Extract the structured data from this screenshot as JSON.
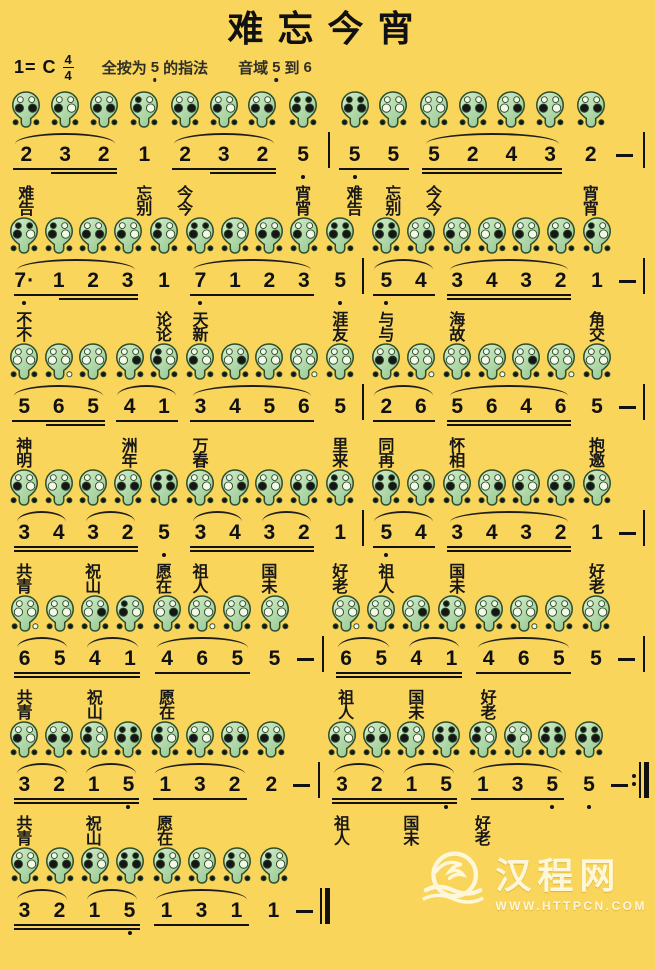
{
  "colors": {
    "bg": "#f9d55c",
    "ink": "#111111",
    "ocarina_light": "#d8efcd",
    "ocarina_dark": "#8fc48b",
    "ocarina_outline": "#2e4d2c",
    "hole_closed": "#161616",
    "hole_open": "#f4f8e6",
    "watermark": "#fffdf0"
  },
  "title": "难忘今宵",
  "header": {
    "key": "1= C",
    "beat_top": "4",
    "beat_bottom": "4",
    "fingering_pre": "全按为",
    "fingering_note": "5",
    "fingering_post": "的指法",
    "range_pre": "音域",
    "range_low": "5",
    "range_mid": "到",
    "range_high": "6"
  },
  "fingering_map": {
    "5.": [
      1,
      1,
      1,
      1,
      1,
      1
    ],
    "7.": [
      1,
      1,
      1,
      0,
      1,
      1
    ],
    "1": [
      1,
      0,
      1,
      0,
      1,
      1
    ],
    "2": [
      0,
      0,
      1,
      1,
      1,
      1
    ],
    "3": [
      0,
      0,
      1,
      0,
      1,
      1
    ],
    "4": [
      0,
      0,
      0,
      1,
      1,
      1
    ],
    "5": [
      0,
      0,
      0,
      0,
      1,
      1
    ],
    "6": [
      0,
      0,
      0,
      0,
      1,
      0
    ]
  },
  "score": {
    "lines": [
      {
        "groups": [
          {
            "u": 1,
            "u2p": true,
            "slurs": [
              [
                0,
                2
              ]
            ],
            "notes": [
              {
                "p": "2",
                "l1": "难",
                "l2": "告"
              },
              {
                "p": "3"
              },
              {
                "p": "2"
              }
            ]
          },
          {
            "notes": [
              {
                "p": "1",
                "l1": "忘",
                "l2": "别"
              }
            ]
          },
          {
            "u": 1,
            "u2p": true,
            "slurs": [
              [
                0,
                2
              ]
            ],
            "notes": [
              {
                "p": "2",
                "l1": "今",
                "l2": "今"
              },
              {
                "p": "3"
              },
              {
                "p": "2"
              }
            ]
          },
          {
            "notes": [
              {
                "p": "5.",
                "l1": "宵",
                "l2": "宵"
              }
            ]
          },
          {
            "type": "bar"
          },
          {
            "u": 1,
            "notes": [
              {
                "p": "5.",
                "l1": "难",
                "l2": "告"
              },
              {
                "p": "5",
                "l1": "忘",
                "l2": "别"
              }
            ]
          },
          {
            "u": 2,
            "slurs": [
              [
                0,
                3
              ]
            ],
            "notes": [
              {
                "p": "5",
                "l1": "今",
                "l2": "今"
              },
              {
                "p": "2"
              },
              {
                "p": "4"
              },
              {
                "p": "3"
              }
            ]
          },
          {
            "notes": [
              {
                "p": "2",
                "l1": "宵",
                "l2": "宵"
              }
            ]
          },
          {
            "type": "dash"
          },
          {
            "type": "bar"
          }
        ]
      },
      {
        "groups": [
          {
            "u": 1,
            "u2p": true,
            "slurs": [
              [
                0,
                3
              ]
            ],
            "notes": [
              {
                "p": "7.",
                "da": true,
                "l1": "不",
                "l2": "不"
              },
              {
                "p": "1"
              },
              {
                "p": "2"
              },
              {
                "p": "3"
              }
            ]
          },
          {
            "notes": [
              {
                "p": "1",
                "l1": "论",
                "l2": "论"
              }
            ]
          },
          {
            "u": 1,
            "slurs": [
              [
                0,
                3
              ]
            ],
            "notes": [
              {
                "p": "7.",
                "l1": "天",
                "l2": "新"
              },
              {
                "p": "1"
              },
              {
                "p": "2"
              },
              {
                "p": "3"
              }
            ]
          },
          {
            "notes": [
              {
                "p": "5.",
                "l1": "涯",
                "l2": "友"
              }
            ]
          },
          {
            "type": "bar"
          },
          {
            "u": 1,
            "slurs": [
              [
                0,
                1
              ]
            ],
            "notes": [
              {
                "p": "5.",
                "l1": "与",
                "l2": "与"
              },
              {
                "p": "4"
              }
            ]
          },
          {
            "u": 2,
            "slurs": [
              [
                0,
                3
              ]
            ],
            "notes": [
              {
                "p": "3",
                "l1": "海",
                "l2": "故"
              },
              {
                "p": "4"
              },
              {
                "p": "3"
              },
              {
                "p": "2"
              }
            ]
          },
          {
            "notes": [
              {
                "p": "1",
                "l1": "角",
                "l2": "交"
              }
            ]
          },
          {
            "type": "dash"
          },
          {
            "type": "bar"
          }
        ]
      },
      {
        "groups": [
          {
            "u": 1,
            "u2p": true,
            "slurs": [
              [
                0,
                2
              ]
            ],
            "notes": [
              {
                "p": "5",
                "l1": "神",
                "l2": "明"
              },
              {
                "p": "6"
              },
              {
                "p": "5"
              }
            ]
          },
          {
            "u": 1,
            "slurs": [
              [
                0,
                1
              ]
            ],
            "notes": [
              {
                "p": "4",
                "l1": "洲",
                "l2": "年"
              },
              {
                "p": "1"
              }
            ]
          },
          {
            "u": 1,
            "slurs": [
              [
                0,
                3
              ]
            ],
            "notes": [
              {
                "p": "3",
                "l1": "万",
                "l2": "春"
              },
              {
                "p": "4"
              },
              {
                "p": "5"
              },
              {
                "p": "6"
              }
            ]
          },
          {
            "notes": [
              {
                "p": "5",
                "l1": "里",
                "l2": "来"
              }
            ]
          },
          {
            "type": "bar"
          },
          {
            "u": 1,
            "slurs": [
              [
                0,
                1
              ]
            ],
            "notes": [
              {
                "p": "2",
                "l1": "同",
                "l2": "再"
              },
              {
                "p": "6"
              }
            ]
          },
          {
            "u": 2,
            "slurs": [
              [
                0,
                3
              ]
            ],
            "notes": [
              {
                "p": "5",
                "l1": "怀",
                "l2": "相"
              },
              {
                "p": "6"
              },
              {
                "p": "4"
              },
              {
                "p": "6"
              }
            ]
          },
          {
            "notes": [
              {
                "p": "5",
                "l1": "抱",
                "l2": "邀"
              }
            ]
          },
          {
            "type": "dash"
          },
          {
            "type": "bar"
          }
        ]
      },
      {
        "groups": [
          {
            "u": 2,
            "slurs": [
              [
                0,
                1
              ],
              [
                2,
                3
              ]
            ],
            "notes": [
              {
                "p": "3",
                "l1": "共",
                "l2": "青"
              },
              {
                "p": "4"
              },
              {
                "p": "3",
                "l1": "祝",
                "l2": "山"
              },
              {
                "p": "2"
              }
            ]
          },
          {
            "notes": [
              {
                "p": "5.",
                "l1": "愿",
                "l2": "在"
              }
            ]
          },
          {
            "u": 2,
            "slurs": [
              [
                0,
                1
              ],
              [
                2,
                3
              ]
            ],
            "notes": [
              {
                "p": "3",
                "l1": "祖",
                "l2": "人"
              },
              {
                "p": "4"
              },
              {
                "p": "3",
                "l1": "国",
                "l2": "未"
              },
              {
                "p": "2"
              }
            ]
          },
          {
            "notes": [
              {
                "p": "1",
                "l1": "好",
                "l2": "老"
              }
            ]
          },
          {
            "type": "bar"
          },
          {
            "u": 1,
            "slurs": [
              [
                0,
                1
              ]
            ],
            "notes": [
              {
                "p": "5.",
                "l1": "祖",
                "l2": "人"
              },
              {
                "p": "4"
              }
            ]
          },
          {
            "u": 2,
            "slurs": [
              [
                0,
                3
              ]
            ],
            "notes": [
              {
                "p": "3",
                "l1": "国",
                "l2": "未"
              },
              {
                "p": "4"
              },
              {
                "p": "3"
              },
              {
                "p": "2"
              }
            ]
          },
          {
            "notes": [
              {
                "p": "1",
                "l1": "好",
                "l2": "老"
              }
            ]
          },
          {
            "type": "dash"
          },
          {
            "type": "bar"
          }
        ]
      },
      {
        "groups": [
          {
            "u": 2,
            "slurs": [
              [
                0,
                1
              ],
              [
                2,
                3
              ]
            ],
            "notes": [
              {
                "p": "6",
                "l1": "共",
                "l2": "青"
              },
              {
                "p": "5"
              },
              {
                "p": "4",
                "l1": "祝",
                "l2": "山"
              },
              {
                "p": "1"
              }
            ]
          },
          {
            "u": 1,
            "slurs": [
              [
                0,
                2
              ]
            ],
            "notes": [
              {
                "p": "4",
                "l1": "愿",
                "l2": "在"
              },
              {
                "p": "6"
              },
              {
                "p": "5"
              }
            ]
          },
          {
            "notes": [
              {
                "p": "5"
              }
            ]
          },
          {
            "type": "dash"
          },
          {
            "type": "bar"
          },
          {
            "u": 2,
            "slurs": [
              [
                0,
                1
              ],
              [
                2,
                3
              ]
            ],
            "notes": [
              {
                "p": "6",
                "l1": "祖",
                "l2": "人"
              },
              {
                "p": "5"
              },
              {
                "p": "4",
                "l1": "国",
                "l2": "未"
              },
              {
                "p": "1"
              }
            ]
          },
          {
            "u": 1,
            "slurs": [
              [
                0,
                2
              ]
            ],
            "notes": [
              {
                "p": "4",
                "l1": "好",
                "l2": "老"
              },
              {
                "p": "6"
              },
              {
                "p": "5"
              }
            ]
          },
          {
            "notes": [
              {
                "p": "5"
              }
            ]
          },
          {
            "type": "dash"
          },
          {
            "type": "bar"
          }
        ]
      },
      {
        "groups": [
          {
            "u": 2,
            "slurs": [
              [
                0,
                1
              ],
              [
                2,
                3
              ]
            ],
            "notes": [
              {
                "p": "3",
                "l1": "共",
                "l2": "青"
              },
              {
                "p": "2"
              },
              {
                "p": "1",
                "l1": "祝",
                "l2": "山"
              },
              {
                "p": "5."
              }
            ]
          },
          {
            "u": 1,
            "slurs": [
              [
                0,
                2
              ]
            ],
            "notes": [
              {
                "p": "1",
                "l1": "愿",
                "l2": "在"
              },
              {
                "p": "3"
              },
              {
                "p": "2"
              }
            ]
          },
          {
            "notes": [
              {
                "p": "2"
              }
            ]
          },
          {
            "type": "dash"
          },
          {
            "type": "bar"
          },
          {
            "u": 2,
            "slurs": [
              [
                0,
                1
              ],
              [
                2,
                3
              ]
            ],
            "notes": [
              {
                "p": "3",
                "l1": "祖",
                "l2": "人"
              },
              {
                "p": "2"
              },
              {
                "p": "1",
                "l1": "国",
                "l2": "未"
              },
              {
                "p": "5."
              }
            ]
          },
          {
            "u": 1,
            "slurs": [
              [
                0,
                2
              ]
            ],
            "notes": [
              {
                "p": "1",
                "l1": "好",
                "l2": "老"
              },
              {
                "p": "3"
              },
              {
                "p": "5."
              }
            ]
          },
          {
            "notes": [
              {
                "p": "5."
              }
            ]
          },
          {
            "type": "dash"
          },
          {
            "type": "endbar"
          }
        ]
      },
      {
        "groups": [
          {
            "u": 2,
            "slurs": [
              [
                0,
                1
              ],
              [
                2,
                3
              ]
            ],
            "notes": [
              {
                "p": "3"
              },
              {
                "p": "2"
              },
              {
                "p": "1"
              },
              {
                "p": "5."
              }
            ]
          },
          {
            "u": 1,
            "slurs": [
              [
                0,
                2
              ]
            ],
            "notes": [
              {
                "p": "1"
              },
              {
                "p": "3"
              },
              {
                "p": "1"
              }
            ]
          },
          {
            "notes": [
              {
                "p": "1"
              }
            ]
          },
          {
            "type": "dash"
          },
          {
            "type": "finalbar"
          },
          {
            "type": "spacer"
          }
        ]
      }
    ]
  },
  "watermark": {
    "name": "汉程网",
    "url": "WWW.HTTPCN.COM"
  }
}
